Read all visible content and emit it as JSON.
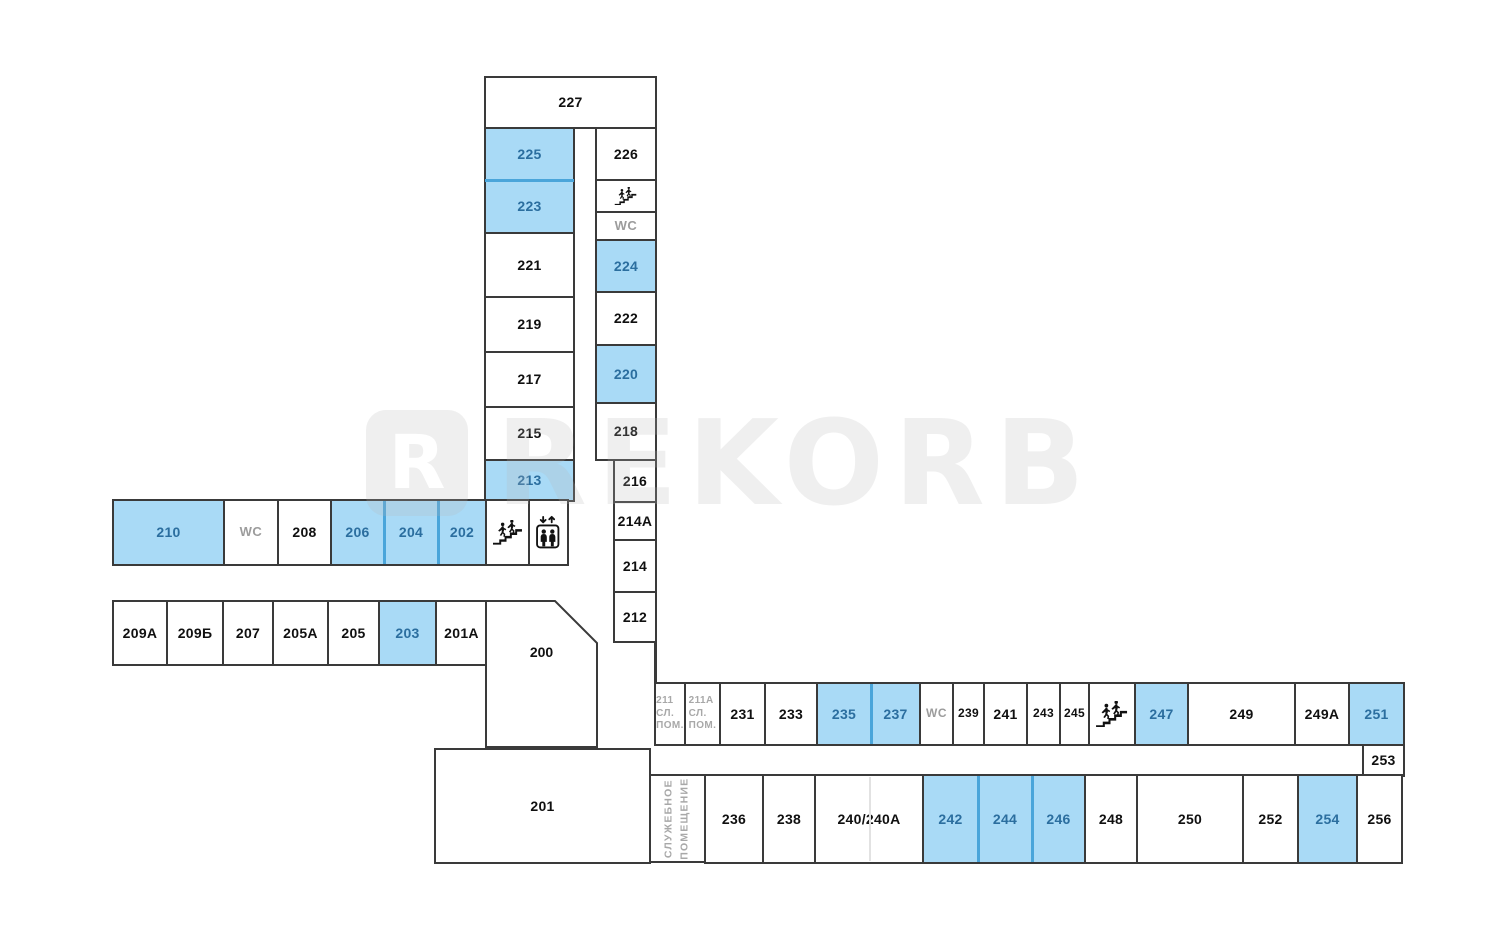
{
  "palette": {
    "background": "#ffffff",
    "wall_border": "#3a3a3a",
    "highlight_fill": "#a9daf6",
    "highlight_text": "#2b6e9f",
    "room_text": "#101010",
    "muted_text": "#a8a8a8",
    "blue_divider": "#4aa5da"
  },
  "watermark": {
    "logo_letter": "R",
    "text": "REKORB"
  },
  "icons": {
    "stairs": "stairs-icon",
    "elevator": "elevator-icon"
  },
  "rooms": [
    {
      "id": "227",
      "label": "227",
      "kind": "room",
      "x": 485,
      "y": 77,
      "w": 171,
      "h": 51
    },
    {
      "id": "225",
      "label": "225",
      "kind": "hl",
      "x": 485,
      "y": 128,
      "w": 89,
      "h": 52
    },
    {
      "id": "223",
      "label": "223",
      "kind": "hl",
      "x": 485,
      "y": 180,
      "w": 89,
      "h": 53
    },
    {
      "id": "221",
      "label": "221",
      "kind": "room",
      "x": 485,
      "y": 233,
      "w": 89,
      "h": 64
    },
    {
      "id": "219",
      "label": "219",
      "kind": "room",
      "x": 485,
      "y": 297,
      "w": 89,
      "h": 55
    },
    {
      "id": "217",
      "label": "217",
      "kind": "room",
      "x": 485,
      "y": 352,
      "w": 89,
      "h": 55
    },
    {
      "id": "215",
      "label": "215",
      "kind": "room",
      "x": 485,
      "y": 407,
      "w": 89,
      "h": 53
    },
    {
      "id": "213",
      "label": "213",
      "kind": "hl",
      "x": 485,
      "y": 460,
      "w": 89,
      "h": 41
    },
    {
      "id": "226",
      "label": "226",
      "kind": "room",
      "x": 596,
      "y": 128,
      "w": 60,
      "h": 52
    },
    {
      "id": "stairs-top",
      "kind": "stairs",
      "x": 596,
      "y": 180,
      "w": 60,
      "h": 32
    },
    {
      "id": "wc-top",
      "label": "WC",
      "kind": "wc",
      "x": 596,
      "y": 212,
      "w": 60,
      "h": 28
    },
    {
      "id": "224",
      "label": "224",
      "kind": "hl",
      "x": 596,
      "y": 240,
      "w": 60,
      "h": 52
    },
    {
      "id": "222",
      "label": "222",
      "kind": "room",
      "x": 596,
      "y": 292,
      "w": 60,
      "h": 53
    },
    {
      "id": "220",
      "label": "220",
      "kind": "hl",
      "x": 596,
      "y": 345,
      "w": 60,
      "h": 58
    },
    {
      "id": "218",
      "label": "218",
      "kind": "room",
      "x": 596,
      "y": 403,
      "w": 60,
      "h": 57
    },
    {
      "id": "216",
      "label": "216",
      "kind": "room",
      "x": 614,
      "y": 460,
      "w": 42,
      "h": 42
    },
    {
      "id": "214A",
      "label": "214A",
      "kind": "room",
      "x": 614,
      "y": 502,
      "w": 42,
      "h": 38
    },
    {
      "id": "214",
      "label": "214",
      "kind": "room",
      "x": 614,
      "y": 540,
      "w": 42,
      "h": 52
    },
    {
      "id": "212",
      "label": "212",
      "kind": "room",
      "x": 614,
      "y": 592,
      "w": 42,
      "h": 50
    },
    {
      "id": "210",
      "label": "210",
      "kind": "hl",
      "x": 113,
      "y": 500,
      "w": 111,
      "h": 65
    },
    {
      "id": "wc-mid",
      "label": "WC",
      "kind": "wc",
      "x": 224,
      "y": 500,
      "w": 54,
      "h": 65
    },
    {
      "id": "208",
      "label": "208",
      "kind": "room",
      "x": 278,
      "y": 500,
      "w": 53,
      "h": 65
    },
    {
      "id": "206",
      "label": "206",
      "kind": "hl",
      "x": 331,
      "y": 500,
      "w": 53,
      "h": 65
    },
    {
      "id": "204",
      "label": "204",
      "kind": "hl",
      "x": 384,
      "y": 500,
      "w": 54,
      "h": 65
    },
    {
      "id": "202",
      "label": "202",
      "kind": "hl",
      "x": 438,
      "y": 500,
      "w": 48,
      "h": 65
    },
    {
      "id": "stairs-mid",
      "kind": "stairs",
      "x": 486,
      "y": 500,
      "w": 43,
      "h": 65
    },
    {
      "id": "elevator",
      "kind": "elevator",
      "x": 529,
      "y": 500,
      "w": 39,
      "h": 65
    },
    {
      "id": "209A",
      "label": "209A",
      "kind": "room",
      "x": 113,
      "y": 601,
      "w": 54,
      "h": 64
    },
    {
      "id": "209B",
      "label": "209Б",
      "kind": "room",
      "x": 167,
      "y": 601,
      "w": 56,
      "h": 64
    },
    {
      "id": "207",
      "label": "207",
      "kind": "room",
      "x": 223,
      "y": 601,
      "w": 50,
      "h": 64
    },
    {
      "id": "205A",
      "label": "205A",
      "kind": "room",
      "x": 273,
      "y": 601,
      "w": 55,
      "h": 64
    },
    {
      "id": "205",
      "label": "205",
      "kind": "room",
      "x": 328,
      "y": 601,
      "w": 51,
      "h": 64
    },
    {
      "id": "203",
      "label": "203",
      "kind": "hl",
      "x": 379,
      "y": 601,
      "w": 57,
      "h": 64
    },
    {
      "id": "201A",
      "label": "201A",
      "kind": "room",
      "x": 436,
      "y": 601,
      "w": 51,
      "h": 64
    },
    {
      "id": "201",
      "label": "201",
      "kind": "room",
      "x": 435,
      "y": 749,
      "w": 215,
      "h": 114
    },
    {
      "id": "211",
      "lines": [
        "211",
        "СЛ.",
        "ПОМ."
      ],
      "kind": "gray",
      "x": 655,
      "y": 683,
      "w": 30,
      "h": 62
    },
    {
      "id": "211A",
      "lines": [
        "211А",
        "СЛ.",
        "ПОМ."
      ],
      "kind": "gray",
      "x": 685,
      "y": 683,
      "w": 35,
      "h": 62
    },
    {
      "id": "231",
      "label": "231",
      "kind": "room",
      "x": 720,
      "y": 683,
      "w": 45,
      "h": 62
    },
    {
      "id": "233",
      "label": "233",
      "kind": "room",
      "x": 765,
      "y": 683,
      "w": 52,
      "h": 62
    },
    {
      "id": "235",
      "label": "235",
      "kind": "hl",
      "x": 817,
      "y": 683,
      "w": 54,
      "h": 62
    },
    {
      "id": "237",
      "label": "237",
      "kind": "hl",
      "x": 871,
      "y": 683,
      "w": 49,
      "h": 62
    },
    {
      "id": "wc-right",
      "label": "WC",
      "kind": "wc",
      "x": 920,
      "y": 683,
      "w": 33,
      "h": 62
    },
    {
      "id": "239",
      "label": "239",
      "kind": "room",
      "x": 953,
      "y": 683,
      "w": 31,
      "h": 62
    },
    {
      "id": "241",
      "label": "241",
      "kind": "room",
      "x": 984,
      "y": 683,
      "w": 43,
      "h": 62
    },
    {
      "id": "243",
      "label": "243",
      "kind": "room",
      "x": 1027,
      "y": 683,
      "w": 33,
      "h": 62
    },
    {
      "id": "245",
      "label": "245",
      "kind": "room",
      "x": 1060,
      "y": 683,
      "w": 29,
      "h": 62
    },
    {
      "id": "stairs-right",
      "kind": "stairs",
      "x": 1089,
      "y": 683,
      "w": 46,
      "h": 62
    },
    {
      "id": "247",
      "label": "247",
      "kind": "hl",
      "x": 1135,
      "y": 683,
      "w": 53,
      "h": 62
    },
    {
      "id": "249",
      "label": "249",
      "kind": "room",
      "x": 1188,
      "y": 683,
      "w": 107,
      "h": 62
    },
    {
      "id": "249A",
      "label": "249A",
      "kind": "room",
      "x": 1295,
      "y": 683,
      "w": 54,
      "h": 62
    },
    {
      "id": "251",
      "label": "251",
      "kind": "hl",
      "x": 1349,
      "y": 683,
      "w": 55,
      "h": 62
    },
    {
      "id": "253",
      "label": "253",
      "kind": "room",
      "x": 1363,
      "y": 745,
      "w": 41,
      "h": 31
    },
    {
      "id": "service-room",
      "lines": [
        "СЛУЖЕБНОЕ",
        "ПОМЕЩЕНИЕ"
      ],
      "kind": "service",
      "x": 650,
      "y": 775,
      "w": 55,
      "h": 87
    },
    {
      "id": "236",
      "label": "236",
      "kind": "room",
      "x": 705,
      "y": 775,
      "w": 58,
      "h": 88
    },
    {
      "id": "238",
      "label": "238",
      "kind": "room",
      "x": 763,
      "y": 775,
      "w": 52,
      "h": 88
    },
    {
      "id": "240-240A",
      "label": "240/240A",
      "kind": "room",
      "x": 815,
      "y": 775,
      "w": 108,
      "h": 88
    },
    {
      "id": "242",
      "label": "242",
      "kind": "hl",
      "x": 923,
      "y": 775,
      "w": 55,
      "h": 88
    },
    {
      "id": "244",
      "label": "244",
      "kind": "hl",
      "x": 978,
      "y": 775,
      "w": 54,
      "h": 88
    },
    {
      "id": "246",
      "label": "246",
      "kind": "hl",
      "x": 1032,
      "y": 775,
      "w": 53,
      "h": 88
    },
    {
      "id": "248",
      "label": "248",
      "kind": "room",
      "x": 1085,
      "y": 775,
      "w": 52,
      "h": 88
    },
    {
      "id": "250",
      "label": "250",
      "kind": "room",
      "x": 1137,
      "y": 775,
      "w": 106,
      "h": 88
    },
    {
      "id": "252",
      "label": "252",
      "kind": "room",
      "x": 1243,
      "y": 775,
      "w": 55,
      "h": 88
    },
    {
      "id": "254",
      "label": "254",
      "kind": "hl",
      "x": 1298,
      "y": 775,
      "w": 59,
      "h": 88
    },
    {
      "id": "256",
      "label": "256",
      "kind": "room",
      "x": 1357,
      "y": 775,
      "w": 45,
      "h": 88
    }
  ],
  "room_200": {
    "id": "200",
    "label": "200",
    "points": "6,6 75,6 117,48 117,152 6,152",
    "x": 480,
    "y": 595,
    "w": 123,
    "h": 158
  },
  "walls": [
    {
      "x": 654,
      "y": 642,
      "w": 3,
      "h": 42
    }
  ],
  "blue_dividers": [
    {
      "x": 485,
      "y": 179,
      "w": 89,
      "h": 3
    },
    {
      "x": 383,
      "y": 501,
      "w": 3,
      "h": 63
    },
    {
      "x": 437,
      "y": 501,
      "w": 3,
      "h": 63
    },
    {
      "x": 870,
      "y": 684,
      "w": 3,
      "h": 60
    },
    {
      "x": 977,
      "y": 776,
      "w": 3,
      "h": 86
    },
    {
      "x": 1031,
      "y": 776,
      "w": 3,
      "h": 86
    }
  ],
  "faint_dividers": [
    {
      "x": 869,
      "y": 777,
      "w": 2,
      "h": 84
    }
  ]
}
